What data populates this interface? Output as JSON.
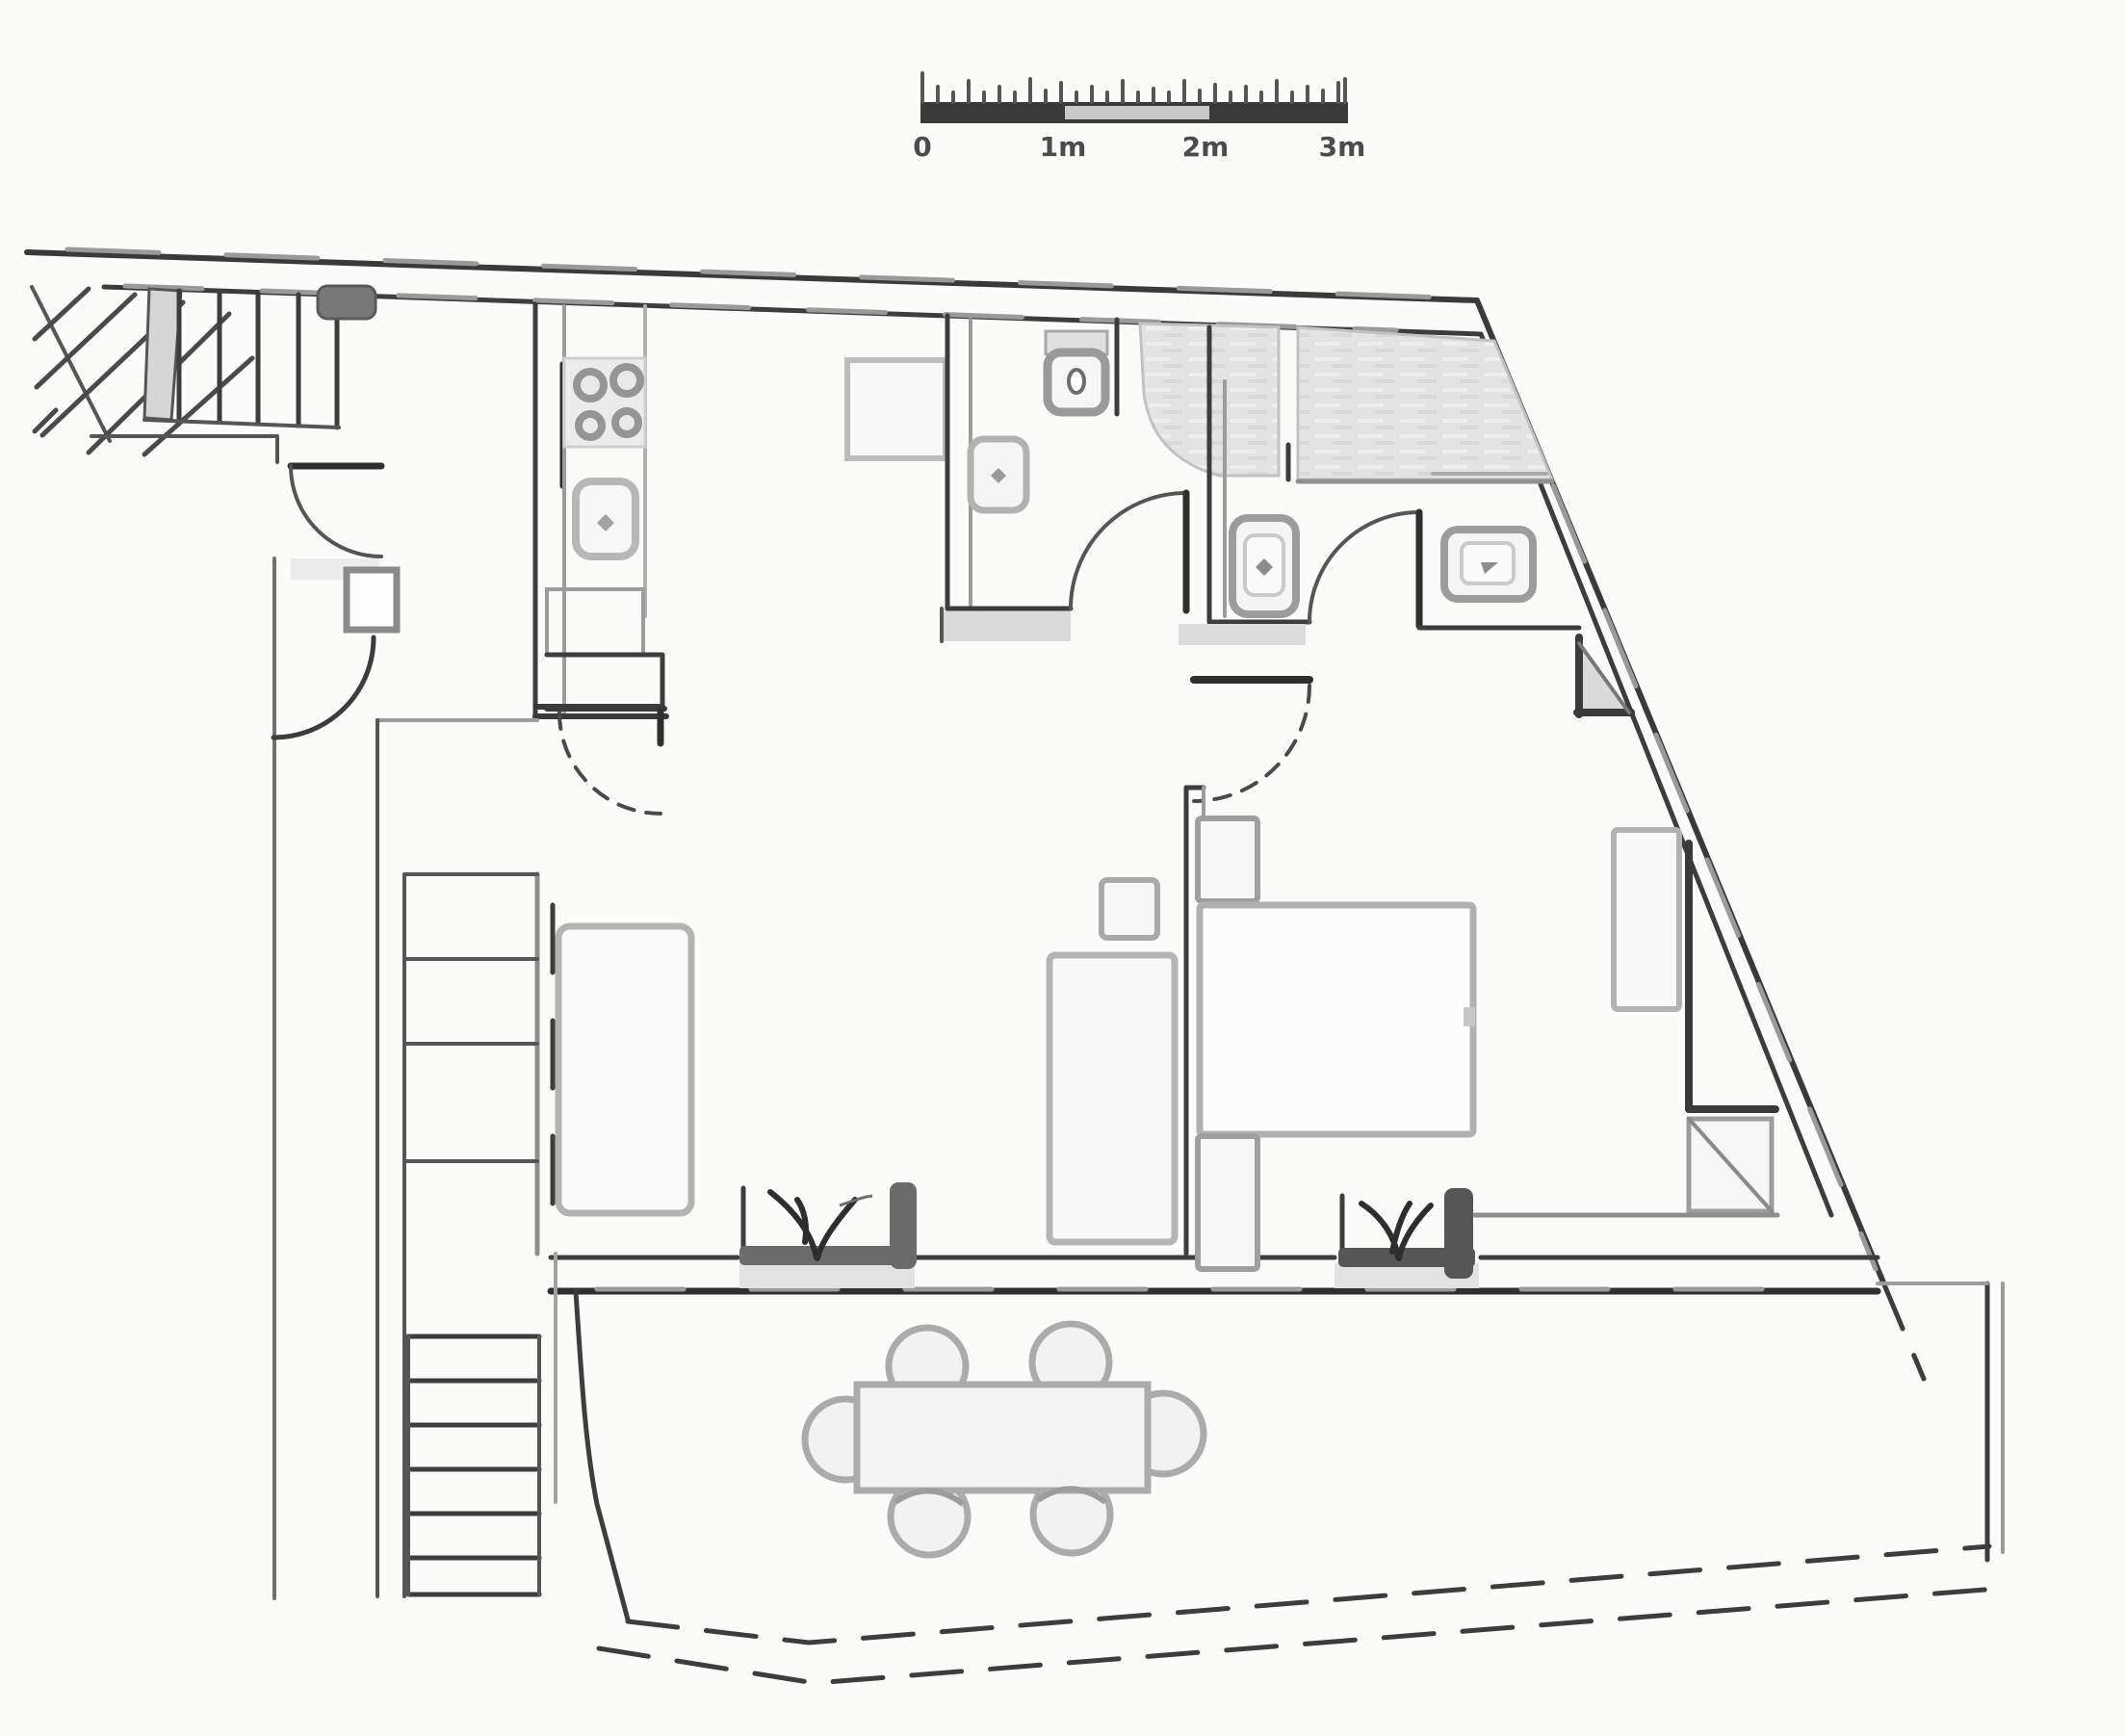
{
  "document": {
    "kind": "architectural floor plan, hand-traced line drawing, no text labels except scale bar"
  },
  "scale_bar": {
    "labels": [
      "0",
      "1m",
      "2m",
      "3m"
    ],
    "bar_color": "#3a3a3a",
    "middle_segment_color": "#c8c8c8",
    "label_color": "#4b4b4b"
  },
  "colors": {
    "paper": "#fbfbfa",
    "ink": "#3a3a3a",
    "ink_strong": "#2f2f2f",
    "mid_gray": "#9c9c9c",
    "soft_gray": "#b3b3b3",
    "light_gray": "#dcdcdc",
    "tile_gray": "#e3e3e3",
    "fixture_fill": "#f7f7f7",
    "planter_dark": "#6b6b6b"
  },
  "fixtures": {
    "entry_stair_treads": 5,
    "stove_burners": 4,
    "kitchen_sink": 1,
    "toilets": 1,
    "washbasins": 3,
    "tiled_shower_areas": 2,
    "interior_door_arcs": 6,
    "single_beds": 1,
    "double_beds": 1,
    "nightstands": 2,
    "wardrobes": 2,
    "sideboards": 1,
    "lower_stair_wide_treads": 4,
    "lower_stair_narrow_treads": 6,
    "dining_tables": 1,
    "dining_chairs": 6,
    "planters": 2
  }
}
